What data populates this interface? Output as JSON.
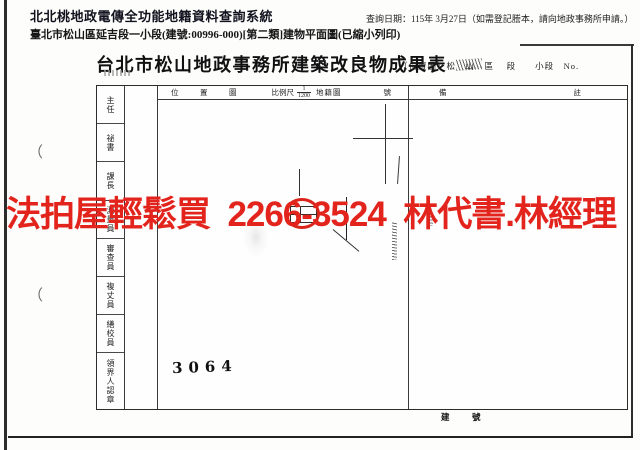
{
  "header": {
    "system_title": "北北桃地政電傳全功能地籍資料查詢系統",
    "query_date": "查詢日期：115年 3月27日（如需登記謄本，請向地政事務所申請。）",
    "document_line": "臺北市松山區延吉段一小段(建號:00996-000)[第二類]建物平面圖(已縮小列印)"
  },
  "document": {
    "title": "台北市松山地政事務所建築改良物成果表",
    "title_suffix": "（位置圖）松　山　區　 段　　小段　No.",
    "plan_header": {
      "location_map": "位　置　圖",
      "scale_label": "比例尺",
      "scale": {
        "numerator": "1",
        "denominator": "1200"
      },
      "cadastral_map": "地籍圖",
      "number": "號"
    },
    "remark_header": {
      "left": "備",
      "right": "註"
    },
    "signature_column": [
      "主任",
      "祕書",
      "課長",
      "測量員",
      "審查員",
      "複丈員",
      "繕校員",
      "領界人認章"
    ],
    "plan_stamp_number": "3064",
    "building_number_label": "建　號",
    "margin_marks": [
      "（",
      "（"
    ]
  },
  "watermark": {
    "text": "法拍屋輕鬆買  2266-3524  林代書.林經理",
    "color": "#e2241c"
  }
}
